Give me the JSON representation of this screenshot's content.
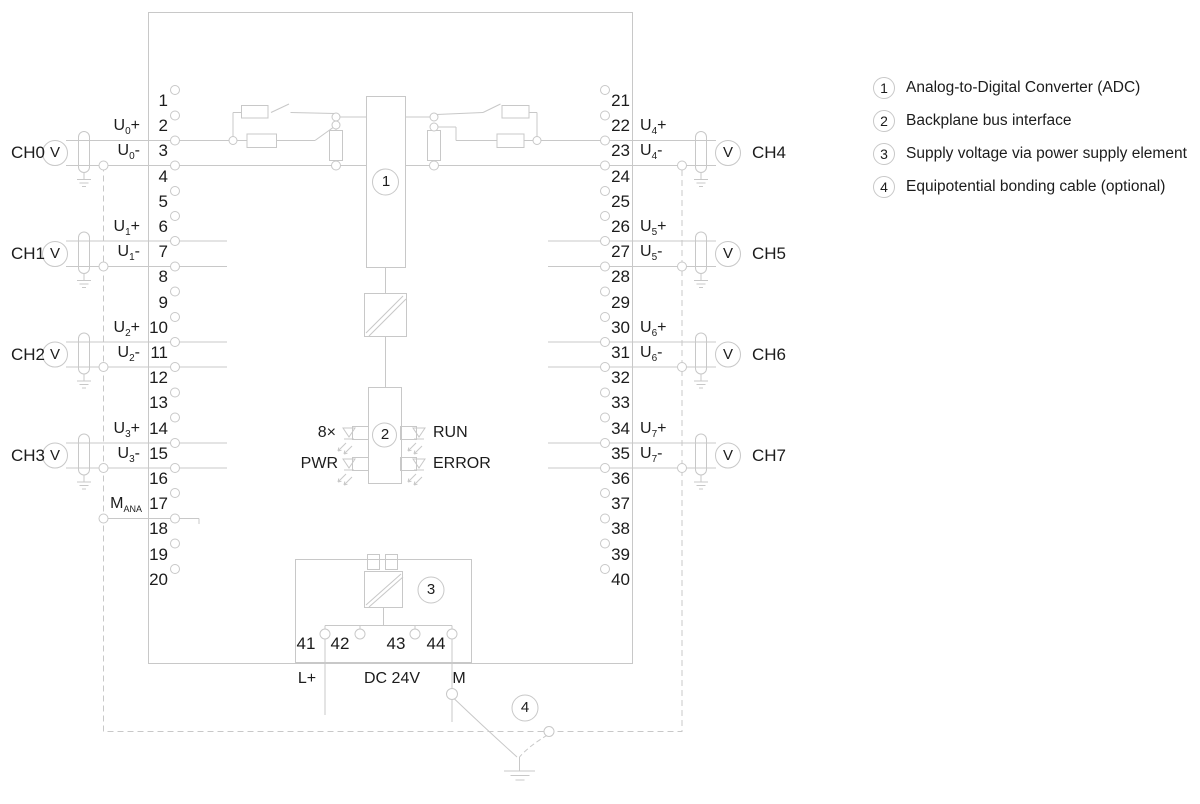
{
  "terminals": {
    "left": [
      "1",
      "2",
      "3",
      "4",
      "5",
      "6",
      "7",
      "8",
      "9",
      "10",
      "11",
      "12",
      "13",
      "14",
      "15",
      "16",
      "17",
      "18",
      "19",
      "20"
    ],
    "right": [
      "21",
      "22",
      "23",
      "24",
      "25",
      "26",
      "27",
      "28",
      "29",
      "30",
      "31",
      "32",
      "33",
      "34",
      "35",
      "36",
      "37",
      "38",
      "39",
      "40"
    ],
    "psu": [
      "41",
      "42",
      "43",
      "44"
    ]
  },
  "channels": {
    "left": [
      {
        "ch": "CH0",
        "u": "U",
        "sub": "0",
        "plus": "+",
        "minus": "-"
      },
      {
        "ch": "CH1",
        "u": "U",
        "sub": "1",
        "plus": "+",
        "minus": "-"
      },
      {
        "ch": "CH2",
        "u": "U",
        "sub": "2",
        "plus": "+",
        "minus": "-"
      },
      {
        "ch": "CH3",
        "u": "U",
        "sub": "3",
        "plus": "+",
        "minus": "-"
      }
    ],
    "right": [
      {
        "ch": "CH4",
        "u": "U",
        "sub": "4",
        "plus": "+",
        "minus": "-"
      },
      {
        "ch": "CH5",
        "u": "U",
        "sub": "5",
        "plus": "+",
        "minus": "-"
      },
      {
        "ch": "CH6",
        "u": "U",
        "sub": "6",
        "plus": "+",
        "minus": "-"
      },
      {
        "ch": "CH7",
        "u": "U",
        "sub": "7",
        "plus": "+",
        "minus": "-"
      }
    ]
  },
  "meter_label": "V",
  "mana": {
    "m": "M",
    "sub": "ANA"
  },
  "blocks": {
    "adc": "1",
    "bus": "2",
    "psu": "3",
    "bond": "4"
  },
  "leds": {
    "count": "8×",
    "pwr": "PWR",
    "run": "RUN",
    "error": "ERROR"
  },
  "power": {
    "lplus": "L+",
    "dc": "DC 24V",
    "m": "M"
  },
  "legend": {
    "items": [
      {
        "num": "1",
        "text": "Analog-to-Digital Converter (ADC)"
      },
      {
        "num": "2",
        "text": "Backplane bus interface"
      },
      {
        "num": "3",
        "text": "Supply voltage via power supply element"
      },
      {
        "num": "4",
        "text": "Equipotential bonding cable (optional)"
      }
    ]
  },
  "colors": {
    "line": "#c8c8c8",
    "text": "#1c1c1c",
    "background": "#ffffff"
  }
}
